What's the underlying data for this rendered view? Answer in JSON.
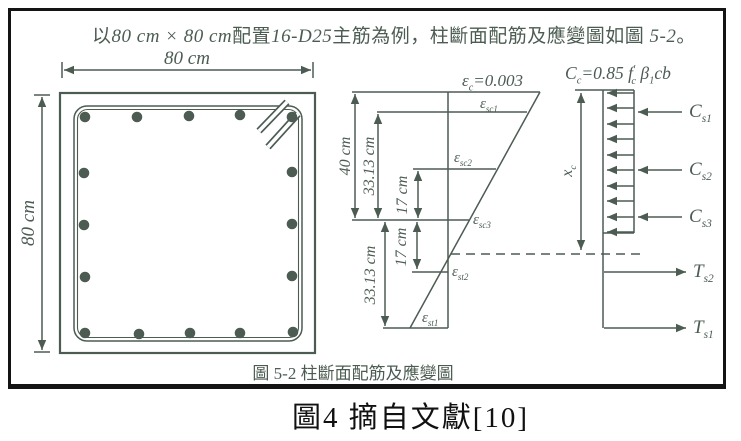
{
  "colors": {
    "ink": "#4c5c52",
    "frame": "#141414"
  },
  "intro": {
    "parts": [
      "以",
      "80 cm × 80 cm",
      "配置",
      "16-D25",
      "主筋為例，柱斷面配筋及應變圖如圖 ",
      "5-2",
      "。"
    ]
  },
  "section": {
    "top_dim": "80 cm",
    "left_dim": "80 cm",
    "rebar_count": 16
  },
  "strain": {
    "dim_40": "40 cm",
    "dim_3313_top": "33.13 cm",
    "dim_17_top": "17 cm",
    "dim_17_bottom": "17 cm",
    "dim_3313_bottom": "33.13 cm",
    "ec": {
      "sym": "ε",
      "sub": "c",
      "rest": "=0.003"
    },
    "esc1": {
      "sym": "ε",
      "sub": "sc1"
    },
    "esc2": {
      "sym": "ε",
      "sub": "sc2"
    },
    "esc3": {
      "sym": "ε",
      "sub": "sc3"
    },
    "est2": {
      "sym": "ε",
      "sub": "st2"
    },
    "est1": {
      "sym": "ε",
      "sub": "st1"
    }
  },
  "stress": {
    "title": {
      "c": "C",
      "c_sub": "c",
      "eq": "=0.85 ",
      "f": "f",
      "f_sup": "′",
      "f_sub": "c",
      "beta": " β",
      "beta_sub": "1",
      "tail": "cb"
    },
    "xc": {
      "sym": "x",
      "sub": "c"
    },
    "cs1": {
      "sym": "C",
      "sub": "s1"
    },
    "cs2": {
      "sym": "C",
      "sub": "s2"
    },
    "cs3": {
      "sym": "C",
      "sub": "s3"
    },
    "ts2": {
      "sym": "T",
      "sub": "s2"
    },
    "ts1": {
      "sym": "T",
      "sub": "s1"
    }
  },
  "captions": {
    "figure_5_2": "圖  5-2  柱斷面配筋及應變圖",
    "figure_4": "圖4 摘自文獻[10]"
  }
}
